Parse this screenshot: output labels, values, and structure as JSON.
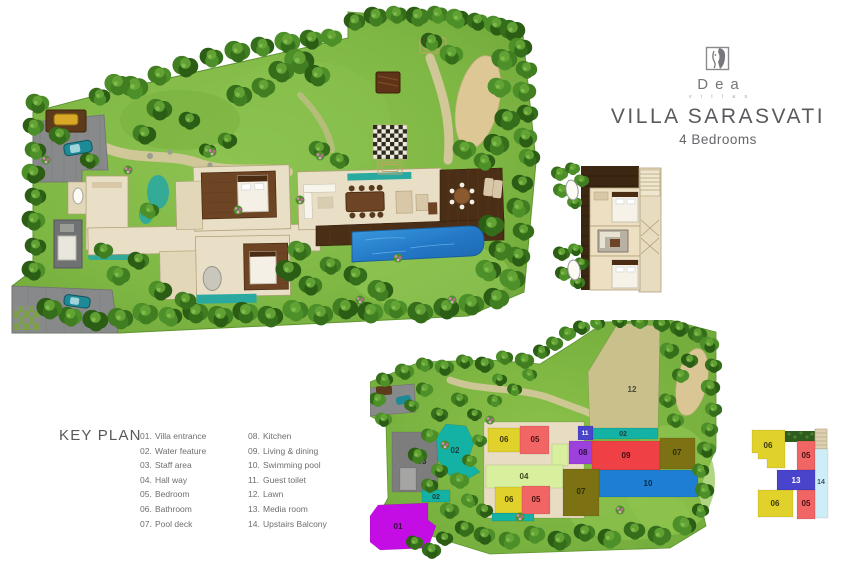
{
  "brand": {
    "name": "Dea",
    "tagline": "v i l l a s"
  },
  "header": {
    "title": "VILLA SARASVATI",
    "subtitle": "4 Bedrooms"
  },
  "key_plan": {
    "heading": "KEY PLAN",
    "items": [
      {
        "num": "01.",
        "label": "Villa entrance"
      },
      {
        "num": "02.",
        "label": "Water feature"
      },
      {
        "num": "03.",
        "label": "Staff area"
      },
      {
        "num": "04.",
        "label": "Hall way"
      },
      {
        "num": "05.",
        "label": "Bedroom"
      },
      {
        "num": "06.",
        "label": "Bathroom"
      },
      {
        "num": "07.",
        "label": "Pool deck"
      },
      {
        "num": "08.",
        "label": "Kitchen"
      },
      {
        "num": "09.",
        "label": "Living & dining"
      },
      {
        "num": "10.",
        "label": "Swimming pool"
      },
      {
        "num": "11.",
        "label": "Guest toilet"
      },
      {
        "num": "12.",
        "label": "Lawn"
      },
      {
        "num": "13.",
        "label": "Media room"
      },
      {
        "num": "14.",
        "label": "Upstairs Balcony"
      }
    ]
  },
  "colors": {
    "villa_entrance": "#c40de4",
    "water_feature": "#14b2a4",
    "staff_area": "#7d7d7d",
    "hall_way": "#d8ef9e",
    "bedroom": "#f26565",
    "bathroom": "#e0d22b",
    "pool_deck": "#7c7213",
    "kitchen": "#9d41dd",
    "living_dining": "#ef4046",
    "swimming_pool": "#1e7fd2",
    "guest_toilet": "#4a43cb",
    "lawn": "#c9c08c",
    "media_room": "#4a43cb",
    "upstairs_balcony": "#cdeef7"
  },
  "ground_key_plan": {
    "blocks": [
      {
        "label": "12",
        "points": "248,3 290,6 288,112 220,112 218,52",
        "color": "#c9c08c",
        "tc": "#4a4a35",
        "lx": 262,
        "ly": 72
      },
      {
        "label": "",
        "shape": "rect",
        "x": 114,
        "y": 102,
        "w": 100,
        "h": 96,
        "color": "#e8dcc2"
      },
      {
        "label": "02",
        "shape": "rect",
        "x": 220,
        "y": 108,
        "w": 68,
        "h": 11,
        "color": "#14b2a4",
        "tc": "#1c3b38",
        "lx": 253,
        "ly": 116,
        "fs": 7
      },
      {
        "label": "03",
        "shape": "rect",
        "x": 22,
        "y": 112,
        "w": 46,
        "h": 60,
        "color": "#7d7d7d",
        "tc": "#2c2c2c",
        "lx": 52,
        "ly": 144
      },
      {
        "label": "",
        "shape": "rect",
        "x": 30,
        "y": 148,
        "w": 16,
        "h": 22,
        "color": "#a5a5a3"
      },
      {
        "label": "02",
        "points": "76,104 96,106 104,122 98,140 110,152 96,160 80,156 68,140 66,118",
        "color": "#14b2a4",
        "tc": "#1c3b38",
        "lx": 85,
        "ly": 133
      },
      {
        "label": "02",
        "shape": "rect",
        "x": 52,
        "y": 170,
        "w": 28,
        "h": 12,
        "color": "#14b2a4",
        "tc": "#1c3b38",
        "lx": 66,
        "ly": 179,
        "fs": 7
      },
      {
        "label": "",
        "shape": "rect",
        "x": 122,
        "y": 193,
        "w": 42,
        "h": 8,
        "color": "#14b2a4"
      },
      {
        "label": "01",
        "points": "8,185 58,183 58,200 66,206 58,228 10,230 0,222 0,196",
        "color": "#c40de4",
        "tc": "#3a0743",
        "lx": 28,
        "ly": 209
      },
      {
        "label": "06",
        "shape": "rect",
        "x": 118,
        "y": 108,
        "w": 32,
        "h": 24,
        "color": "#e0d22b",
        "tc": "#3c3808",
        "lx": 134,
        "ly": 122
      },
      {
        "label": "05",
        "shape": "rect",
        "x": 150,
        "y": 106,
        "w": 29,
        "h": 28,
        "color": "#f26565",
        "tc": "#4b1212",
        "lx": 165,
        "ly": 122
      },
      {
        "label": "",
        "shape": "rect",
        "x": 182,
        "y": 124,
        "w": 16,
        "h": 22,
        "color": "#d8ef9e"
      },
      {
        "label": "04",
        "shape": "rect",
        "x": 116,
        "y": 145,
        "w": 77,
        "h": 23,
        "color": "#d8ef9e",
        "tc": "#3f4a1e",
        "lx": 154,
        "ly": 159
      },
      {
        "label": "06",
        "shape": "rect",
        "x": 125,
        "y": 167,
        "w": 27,
        "h": 26,
        "color": "#e0d22b",
        "tc": "#3c3808",
        "lx": 139,
        "ly": 182
      },
      {
        "label": "05",
        "shape": "rect",
        "x": 152,
        "y": 166,
        "w": 28,
        "h": 28,
        "color": "#f26565",
        "tc": "#4b1212",
        "lx": 166,
        "ly": 182
      },
      {
        "label": "08",
        "shape": "rect",
        "x": 199,
        "y": 121,
        "w": 29,
        "h": 23,
        "color": "#9d41dd",
        "tc": "#2c0b42",
        "lx": 213,
        "ly": 135
      },
      {
        "label": "09",
        "shape": "rect",
        "x": 222,
        "y": 121,
        "w": 68,
        "h": 29,
        "color": "#ef4046",
        "tc": "#43090b",
        "lx": 256,
        "ly": 138
      },
      {
        "label": "07",
        "shape": "rect",
        "x": 290,
        "y": 118,
        "w": 35,
        "h": 31,
        "color": "#7c7213",
        "tc": "#2e2a05",
        "lx": 307,
        "ly": 135
      },
      {
        "label": "10",
        "shape": "rect",
        "x": 229,
        "y": 150,
        "w": 99,
        "h": 27,
        "color": "#1e7fd2",
        "tc": "#082a4a",
        "lx": 278,
        "ly": 166
      },
      {
        "label": "07",
        "shape": "rect",
        "x": 193,
        "y": 149,
        "w": 36,
        "h": 47,
        "color": "#7c7213",
        "tc": "#2e2a05",
        "lx": 211,
        "ly": 174
      },
      {
        "label": "11",
        "shape": "rect",
        "x": 208,
        "y": 106,
        "w": 15,
        "h": 14,
        "color": "#4a43cb",
        "tc": "#ffffff",
        "lx": 215,
        "ly": 115,
        "fs": 6.5
      }
    ]
  },
  "upstairs_key_plan": {
    "blocks": [
      {
        "label": "06",
        "points": "4,6 37,6 37,44 19,44 19,35 10,35 10,29 4,29",
        "color": "#e0d22b",
        "tc": "#3c3808",
        "lx": 20,
        "ly": 24
      },
      {
        "label": "05",
        "shape": "rect",
        "x": 49,
        "y": 17,
        "w": 18,
        "h": 29,
        "color": "#f26565",
        "tc": "#4b1212",
        "lx": 58,
        "ly": 34
      },
      {
        "label": "14",
        "shape": "rect",
        "x": 67,
        "y": 25,
        "w": 13,
        "h": 69,
        "color": "#cdeef7",
        "tc": "#3d555e",
        "lx": 73,
        "ly": 60,
        "fs": 7
      },
      {
        "label": "13",
        "shape": "rect",
        "x": 29,
        "y": 46,
        "w": 38,
        "h": 20,
        "color": "#4a43cb",
        "tc": "#ffffff",
        "lx": 48,
        "ly": 59
      },
      {
        "label": "06",
        "shape": "rect",
        "x": 10,
        "y": 66,
        "w": 35,
        "h": 27,
        "color": "#e0d22b",
        "tc": "#3c3808",
        "lx": 27,
        "ly": 82
      },
      {
        "label": "05",
        "shape": "rect",
        "x": 49,
        "y": 66,
        "w": 18,
        "h": 29,
        "color": "#f26565",
        "tc": "#4b1212",
        "lx": 58,
        "ly": 82
      }
    ]
  }
}
